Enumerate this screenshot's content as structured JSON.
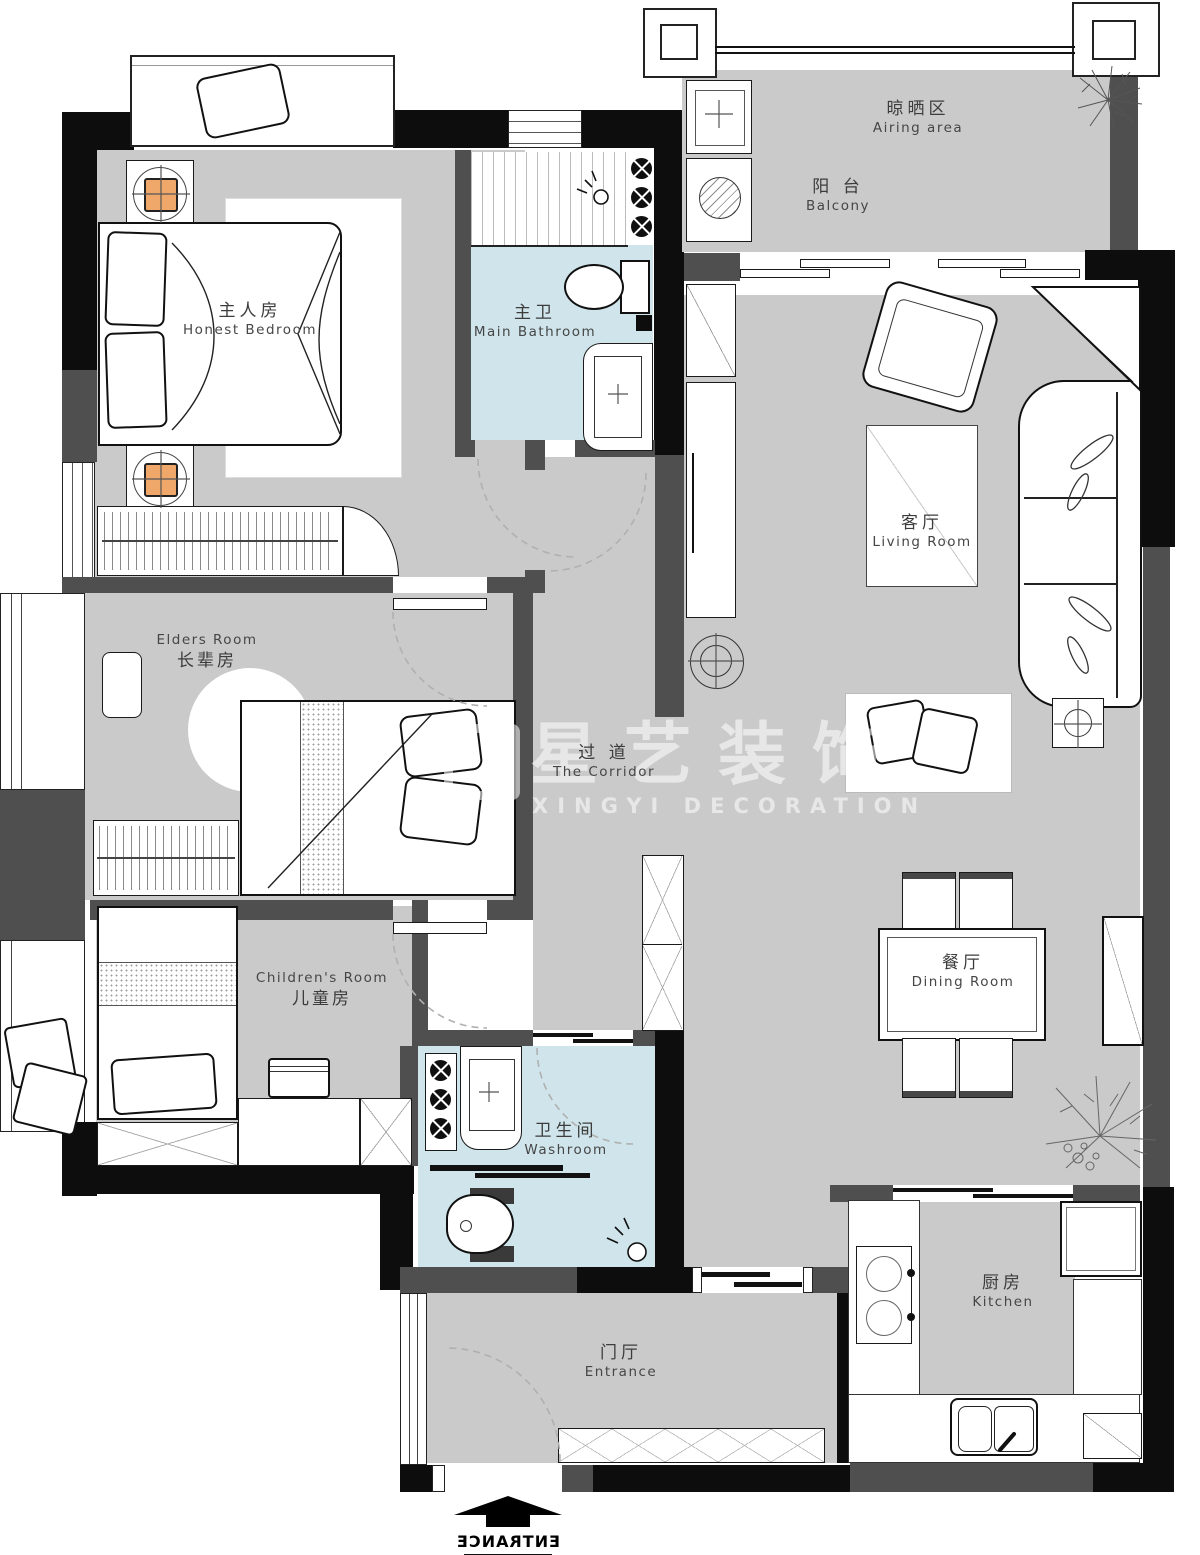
{
  "rooms": {
    "master_bedroom": {
      "line1": "主人房",
      "line2": "Honest Bedroom"
    },
    "main_bathroom": {
      "line1": "主卫",
      "line2": "Main Bathroom"
    },
    "airing_area": {
      "line1": "晾晒区",
      "line2": "Airing area"
    },
    "balcony": {
      "line1": "阳 台",
      "line2": "Balcony"
    },
    "living_room": {
      "line1": "客厅",
      "line2": "Living Room"
    },
    "elders_room": {
      "line1": "Elders Room",
      "line2": "长辈房"
    },
    "corridor": {
      "line1": "过 道",
      "line2": "The Corridor"
    },
    "children_room": {
      "line1": "Children's Room",
      "line2": "儿童房"
    },
    "washroom": {
      "line1": "卫生间",
      "line2": "Washroom"
    },
    "dining_room": {
      "line1": "餐厅",
      "line2": "Dining Room"
    },
    "kitchen": {
      "line1": "厨房",
      "line2": "Kitchen"
    },
    "entrance_hall": {
      "line1": "门厅",
      "line2": "Entrance"
    }
  },
  "watermark": {
    "cn": "星艺装饰",
    "en": "XINGYI DECORATION"
  },
  "entrance_marker": {
    "label": "ENTRANCE"
  },
  "colors": {
    "floor_gray": "#cacaca",
    "bath_floor_blue": "#cfe5eb",
    "wall_gray": "#4f4f4f",
    "wall_black": "#0d0d0d",
    "lamp_orange": "#efa86a",
    "label_text": "#3c3c3c"
  }
}
